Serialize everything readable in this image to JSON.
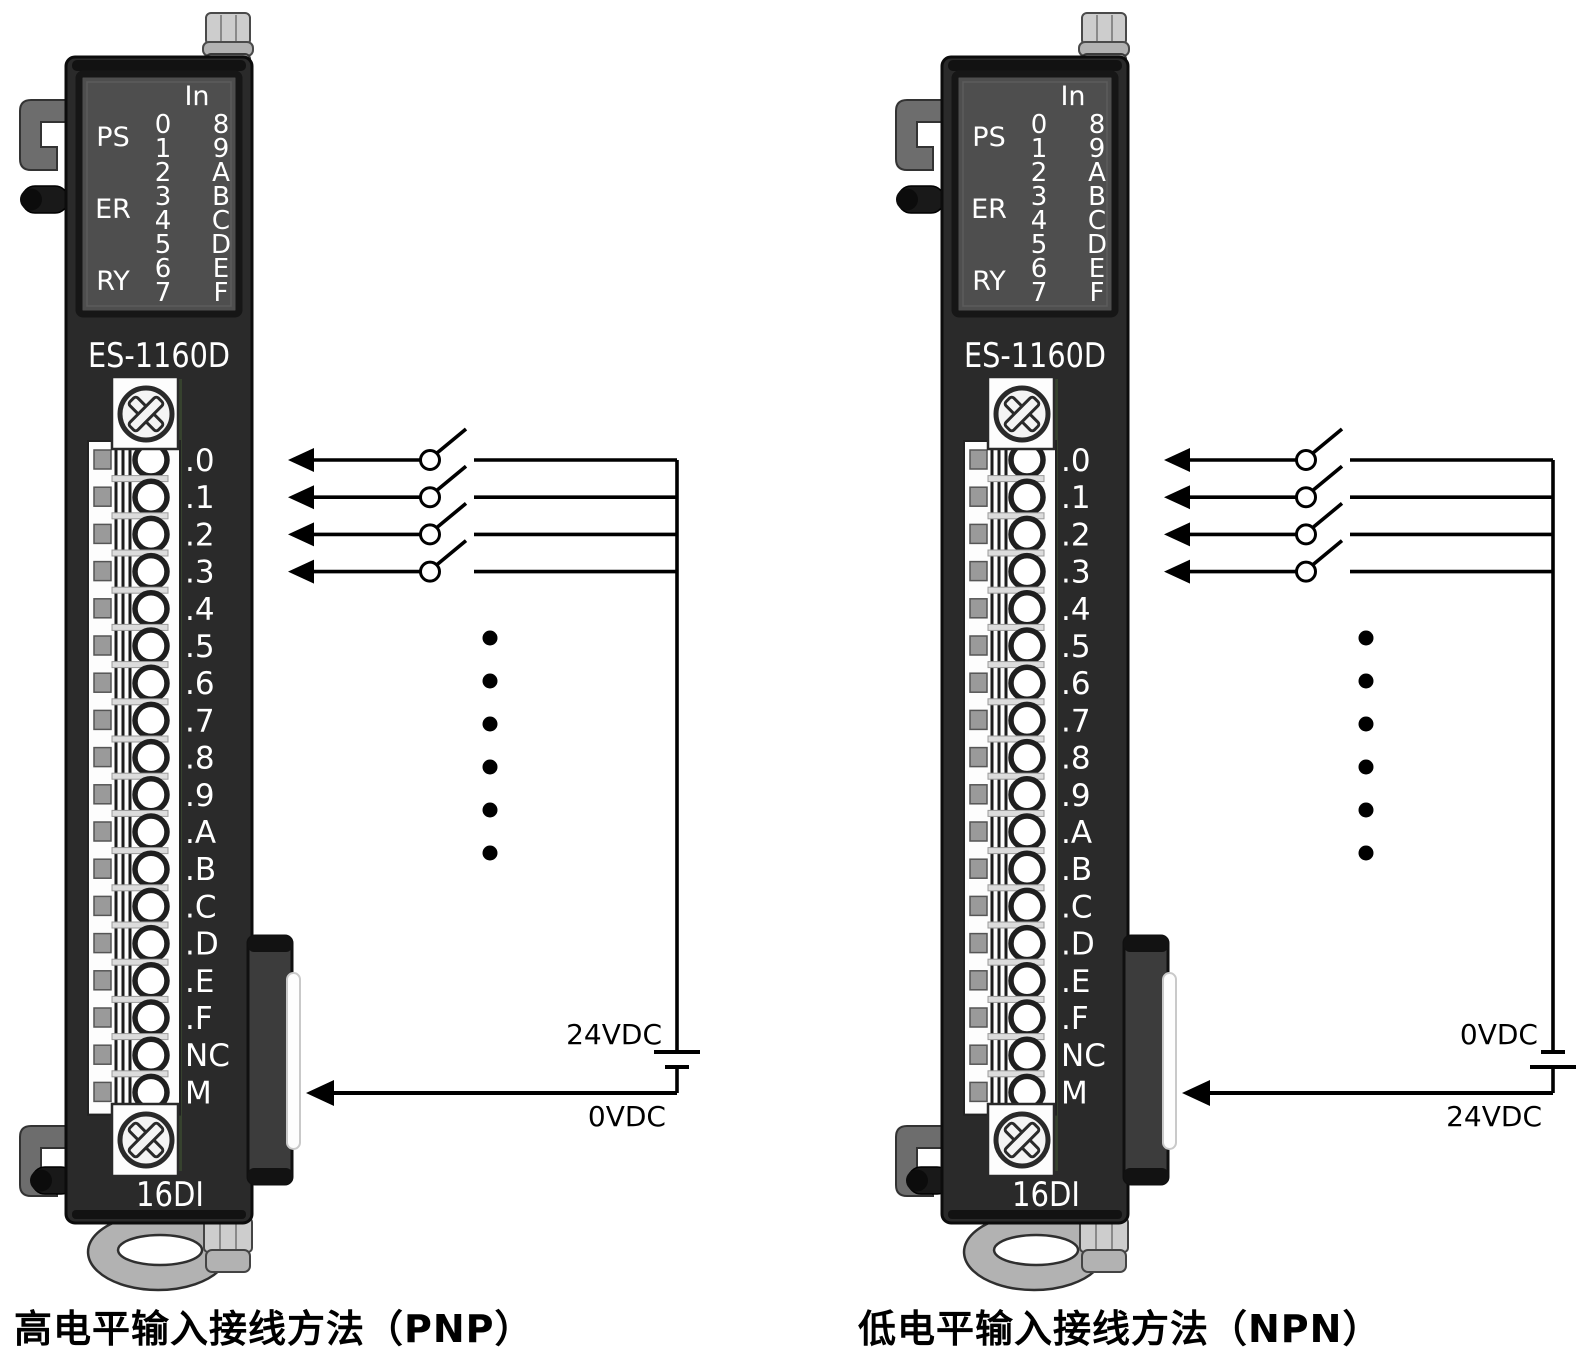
{
  "figures": [
    {
      "id": "pnp",
      "caption": "高电平输入接线方法（PNP）",
      "wiring": {
        "top_label": "24VDC",
        "bottom_label": "0VDC",
        "battery_long_bar": "top",
        "input_lines": 4,
        "ellipsis_dots": 6,
        "inputs_wired": [
          ".0",
          ".1",
          ".2",
          ".3"
        ],
        "return_terminal": "M"
      }
    },
    {
      "id": "npn",
      "caption": "低电平输入接线方法（NPN）",
      "wiring": {
        "top_label": "0VDC",
        "bottom_label": "24VDC",
        "battery_long_bar": "bottom",
        "input_lines": 4,
        "ellipsis_dots": 6,
        "inputs_wired": [
          ".0",
          ".1",
          ".2",
          ".3"
        ],
        "return_terminal": "M"
      }
    }
  ],
  "module": {
    "model": "ES-1160D",
    "bottom_label": "16DI",
    "led_panel": {
      "header": "In",
      "status": [
        "PS",
        "ER",
        "RY"
      ],
      "input_col_left": [
        "0",
        "1",
        "2",
        "3",
        "4",
        "5",
        "6",
        "7"
      ],
      "input_col_right": [
        "8",
        "9",
        "A",
        "B",
        "C",
        "D",
        "E",
        "F"
      ]
    },
    "terminals": [
      ".0",
      ".1",
      ".2",
      ".3",
      ".4",
      ".5",
      ".6",
      ".7",
      ".8",
      ".9",
      ".A",
      ".B",
      ".C",
      ".D",
      ".E",
      ".F",
      "NC",
      "M"
    ]
  },
  "colors": {
    "body": "#2a2a2a",
    "body_edge": "#0c0c0c",
    "panel": "#4e4e4e",
    "panel_edge": "#161616",
    "strip_white": "#fdfdfd",
    "clamp_gray": "#9a9a9a",
    "pcb_green": "#36422e",
    "connector": "#3c3c3c",
    "metal_light": "#cdcdcd",
    "metal_mid": "#b2b2b2",
    "bracket": "#6d6d6d",
    "knob": "#191919",
    "wire": "#000000",
    "module_text": "#ffffff",
    "caption_text": "#000000"
  }
}
